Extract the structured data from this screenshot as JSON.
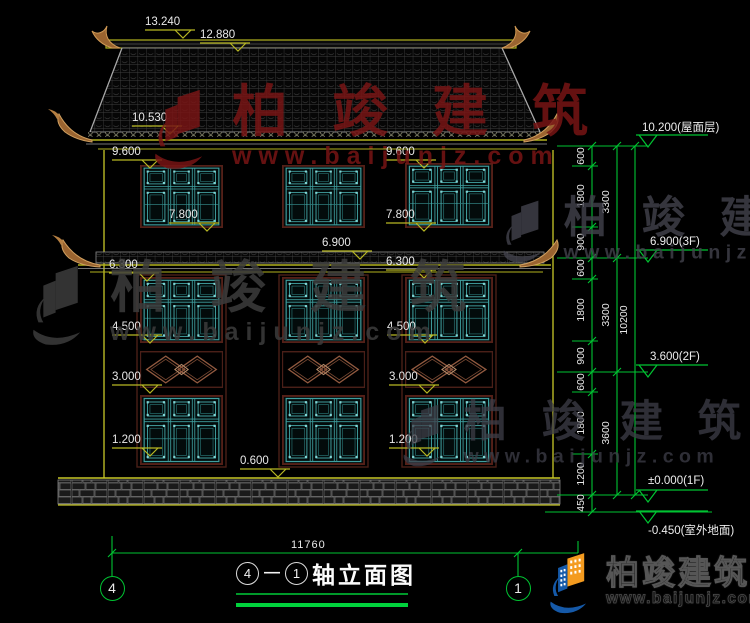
{
  "title": {
    "axis_left": "4",
    "separator": "—",
    "axis_right": "1",
    "text": "轴立面图"
  },
  "total_width_label": "11760",
  "watermark": {
    "cjk": "柏竣建筑",
    "url": "www.baijunjz.com",
    "instances": [
      {
        "x": 148,
        "y": 84,
        "scale": 1.0,
        "color": "#771515",
        "opacity": 0.85
      },
      {
        "x": 26,
        "y": 260,
        "scale": 1.0,
        "color": "#3c3c3c",
        "opacity": 0.85
      },
      {
        "x": 498,
        "y": 196,
        "scale": 0.78,
        "color": "#43434d",
        "opacity": 0.8
      },
      {
        "x": 398,
        "y": 400,
        "scale": 0.78,
        "color": "#3e3e48",
        "opacity": 0.75
      }
    ]
  },
  "logo_block": {
    "cjk": "柏竣建筑",
    "url": "www.baijunjz.com"
  },
  "dimensions": {
    "elevation_tags": [
      {
        "text": "13.240",
        "x": 145,
        "y": 16
      },
      {
        "text": "12.880",
        "x": 200,
        "y": 29
      },
      {
        "text": "10.530",
        "x": 132,
        "y": 112
      },
      {
        "text": "9.600",
        "x": 112,
        "y": 146
      },
      {
        "text": "9.600",
        "x": 386,
        "y": 146
      },
      {
        "text": "7.800",
        "x": 169,
        "y": 209
      },
      {
        "text": "7.800",
        "x": 386,
        "y": 209
      },
      {
        "text": "6.900",
        "x": 322,
        "y": 237
      },
      {
        "text": "6.300",
        "x": 109,
        "y": 259
      },
      {
        "text": "6.300",
        "x": 386,
        "y": 256
      },
      {
        "text": "4.500",
        "x": 112,
        "y": 321
      },
      {
        "text": "4.500",
        "x": 387,
        "y": 321
      },
      {
        "text": "3.000",
        "x": 112,
        "y": 371
      },
      {
        "text": "3.000",
        "x": 389,
        "y": 371
      },
      {
        "text": "1.200",
        "x": 112,
        "y": 434
      },
      {
        "text": "1.200",
        "x": 389,
        "y": 434
      },
      {
        "text": "0.600",
        "x": 240,
        "y": 455
      }
    ],
    "right_chain": {
      "col1": {
        "x": 581,
        "items": [
          {
            "t": "600",
            "y": 156
          },
          {
            "t": "1800",
            "y": 196
          },
          {
            "t": "900",
            "y": 242
          },
          {
            "t": "600",
            "y": 268
          },
          {
            "t": "1800",
            "y": 310
          },
          {
            "t": "900",
            "y": 356
          },
          {
            "t": "600",
            "y": 382
          },
          {
            "t": "1800",
            "y": 423
          },
          {
            "t": "1200",
            "y": 474
          },
          {
            "t": "450",
            "y": 503
          }
        ]
      },
      "col2": {
        "x": 606,
        "items": [
          {
            "t": "3300",
            "y": 202
          },
          {
            "t": "3300",
            "y": 315
          },
          {
            "t": "3600",
            "y": 433
          }
        ]
      },
      "col3": {
        "x": 624,
        "items": [
          {
            "t": "10200",
            "y": 320
          }
        ]
      }
    },
    "level_markers": [
      {
        "text": "10.200(屋面层)",
        "tx": 642,
        "ty": 119,
        "lx": 636,
        "ly": 134
      },
      {
        "text": "6.900(3F)",
        "tx": 650,
        "ty": 236,
        "lx": 636,
        "ly": 249
      },
      {
        "text": "3.600(2F)",
        "tx": 650,
        "ty": 351,
        "lx": 636,
        "ly": 364
      },
      {
        "text": "±0.000(1F)",
        "tx": 648,
        "ty": 475,
        "lx": 636,
        "ly": 489
      },
      {
        "text": "-0.450(室外地面)",
        "tx": 648,
        "ty": 522,
        "lx": 636,
        "ly": 510
      }
    ]
  },
  "axis_bubbles": [
    {
      "label": "4",
      "cx": 112,
      "cy": 588
    },
    {
      "label": "1",
      "cx": 518,
      "cy": 588
    }
  ],
  "facade": {
    "windows": [
      {
        "x": 140,
        "y": 165,
        "w": 83,
        "h": 63
      },
      {
        "x": 282,
        "y": 165,
        "w": 83,
        "h": 63
      },
      {
        "x": 405,
        "y": 163,
        "w": 88,
        "h": 65
      },
      {
        "x": 140,
        "y": 277,
        "w": 83,
        "h": 66
      },
      {
        "x": 282,
        "y": 277,
        "w": 83,
        "h": 66
      },
      {
        "x": 405,
        "y": 277,
        "w": 88,
        "h": 66
      },
      {
        "x": 140,
        "y": 395,
        "w": 83,
        "h": 70
      },
      {
        "x": 282,
        "y": 395,
        "w": 83,
        "h": 70
      },
      {
        "x": 405,
        "y": 395,
        "w": 88,
        "h": 70
      }
    ],
    "diamond_bands": [
      {
        "x": 140,
        "y": 351,
        "w": 83,
        "h": 37
      },
      {
        "x": 282,
        "y": 351,
        "w": 83,
        "h": 37
      },
      {
        "x": 405,
        "y": 351,
        "w": 88,
        "h": 37
      }
    ],
    "column_frames": [
      {
        "x": 137,
        "y": 275,
        "w": 89,
        "h": 192
      },
      {
        "x": 279,
        "y": 275,
        "w": 89,
        "h": 192
      },
      {
        "x": 402,
        "y": 275,
        "w": 94,
        "h": 192
      }
    ]
  },
  "colors": {
    "dim_yellow": "#b8b823",
    "chain_green": "#00c432",
    "window_teal": "#3f9f9f",
    "frame_brown": "#542018",
    "ornament_brown": "#a06a30",
    "watermark_red": "#771515",
    "logo_orange": "#f49b1f",
    "logo_blue": "#1559a8"
  }
}
